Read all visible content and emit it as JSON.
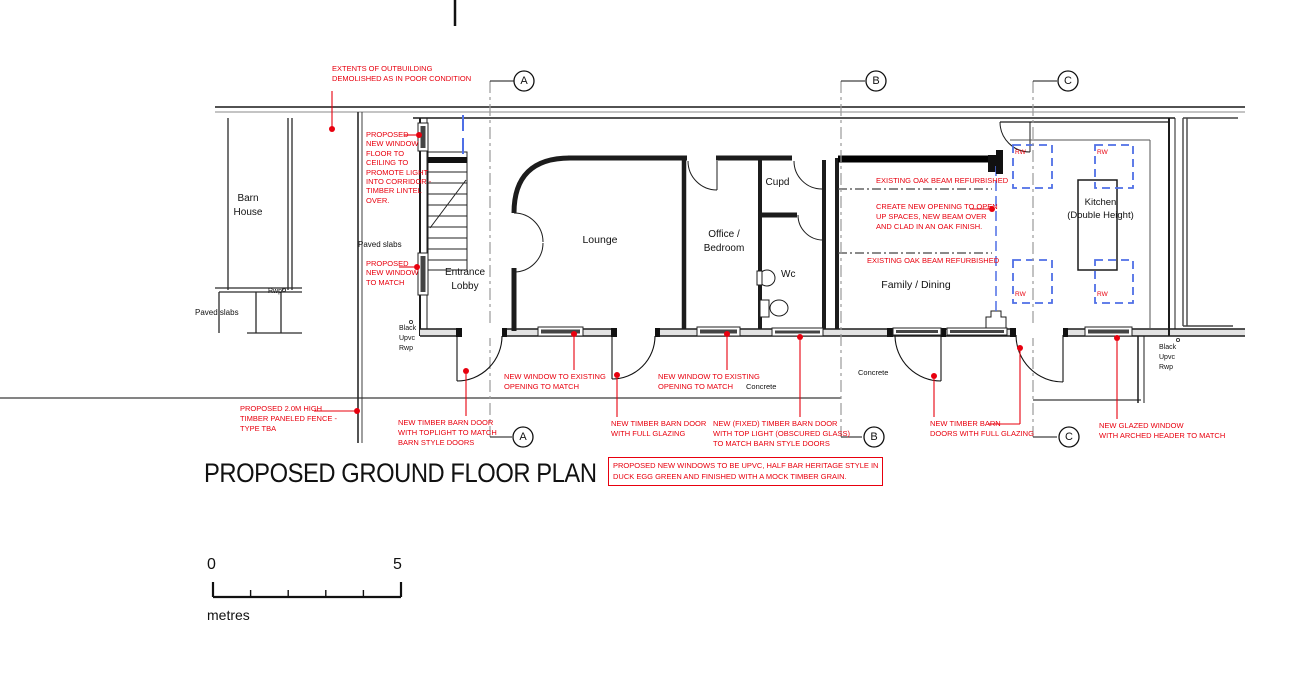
{
  "colors": {
    "annotation_red": "#e8000e",
    "dashed_blue": "#4f6fe6",
    "wall_black": "#1c1c1c",
    "grid_gray": "#9a9a9a"
  },
  "title": "PROPOSED GROUND FLOOR PLAN",
  "grid": {
    "a": "A",
    "b": "B",
    "c": "C"
  },
  "scale_bar": {
    "zero": "0",
    "five": "5",
    "unit": "metres"
  },
  "rooms": {
    "barn_house": "Barn\nHouse",
    "entrance_lobby": "Entrance\nLobby",
    "lounge": "Lounge",
    "office_bedroom": "Office /\nBedroom",
    "cupd": "Cupd",
    "wc": "Wc",
    "family_dining": "Family / Dining",
    "kitchen": "Kitchen\n(Double Height)"
  },
  "site": {
    "paved_slabs_yard": "Paved slabs",
    "paved_slabs_left": "Paved slabs",
    "rwp": "Rwp°",
    "black_upvc": "Black\nUpvc\nRwp",
    "concrete": "Concrete",
    "rw": "RW"
  },
  "annotations": {
    "extents": "EXTENTS OF OUTBUILDING\nDEMOLISHED AS IN POOR CONDITION",
    "window_floor_to_ceiling": "PROPOSED\nNEW WINDOW\nFLOOR TO\nCEILING TO\nPROMOTE LIGHT\nINTO CORRIDOR -\nTIMBER LINTEL\nOVER.",
    "window_to_match": "PROPOSED\nNEW WINDOW\nTO MATCH",
    "fence": "PROPOSED 2.0M HIGH\nTIMBER PANELED FENCE -\nTYPE TBA",
    "barn_door_toplight": "NEW TIMBER BARN DOOR\nWITH TOPLIGHT TO MATCH\nBARN STYLE DOORS",
    "window_existing_1": "NEW WINDOW TO EXISTING\nOPENING TO MATCH",
    "barn_door_glazing": "NEW TIMBER BARN DOOR\nWITH FULL GLAZING",
    "window_existing_2": "NEW WINDOW TO EXISTING\nOPENING TO MATCH",
    "fixed_barn_door": "NEW (FIXED) TIMBER BARN DOOR\nWITH TOP LIGHT (OBSCURED GLASS)\nTO MATCH BARN STYLE DOORS",
    "upvc_note": "PROPOSED NEW WINDOWS TO BE UPVC, HALF BAR HERITAGE STYLE IN\nDUCK EGG GREEN AND FINISHED WITH A MOCK TIMBER GRAIN.",
    "barn_doors_glazing": "NEW TIMBER BARN\nDOORS WITH FULL GLAZING",
    "glazed_arched": "NEW GLAZED WINDOW\nWITH ARCHED HEADER TO MATCH",
    "oak_beam_1": "EXISTING OAK BEAM REFURBISHED",
    "oak_beam_2": "EXISTING OAK BEAM REFURBISHED",
    "create_opening": "CREATE NEW OPENING TO OPEN\nUP SPACES, NEW BEAM OVER\nAND CLAD IN AN OAK FINISH."
  }
}
